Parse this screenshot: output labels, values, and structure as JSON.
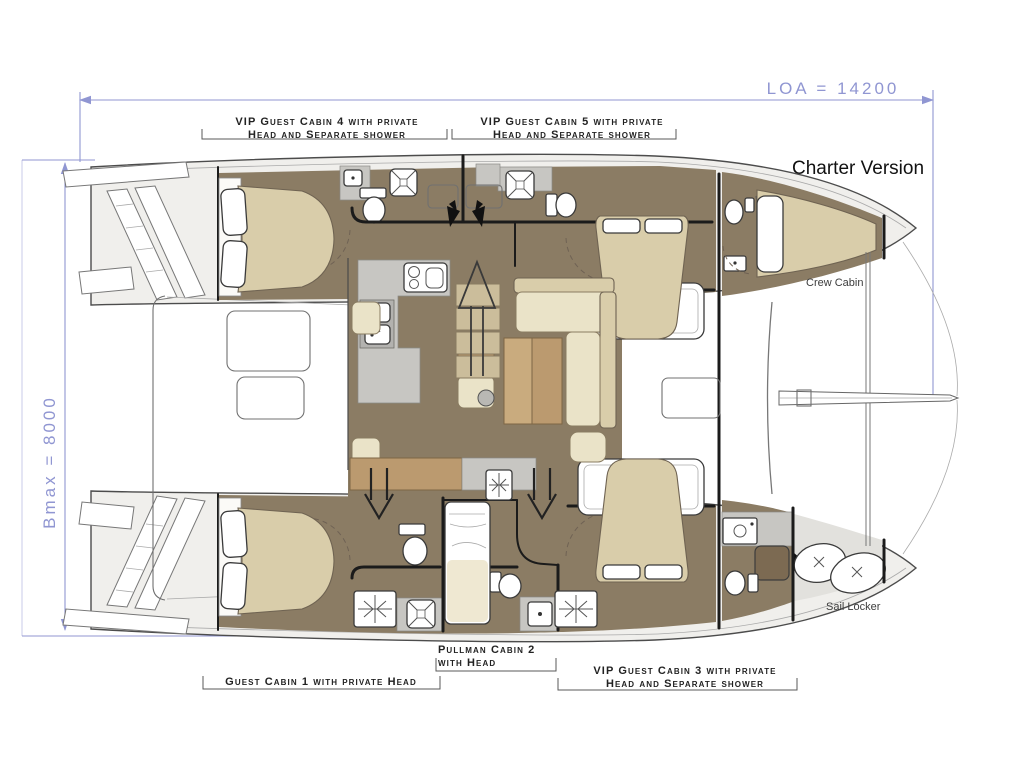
{
  "title": {
    "charter_version": "Charter Version"
  },
  "dimensions": {
    "loa_label": "LOA = 14200",
    "bmax_label": "Bmax = 8000"
  },
  "cabin_labels": {
    "vip4": {
      "line1": "VIP Guest Cabin 4 with private",
      "line2": "Head and Separate shower"
    },
    "vip5": {
      "line1": "VIP Guest Cabin 5 with private",
      "line2": "Head and Separate shower"
    },
    "pullman2": {
      "line1": "Pullman Cabin 2",
      "line2": "with Head"
    },
    "guest1": {
      "line1": "Guest Cabin 1 with private Head"
    },
    "vip3": {
      "line1": "VIP Guest Cabin 3 with private",
      "line2": "Head and Separate shower"
    },
    "crew": {
      "line1": "Crew Cabin"
    },
    "sail_locker": {
      "line1": "Sail Locker"
    }
  },
  "colors": {
    "dimension_blue": "#9096d2",
    "outline_black": "#1b1b1b",
    "deck_gray": "#f0efec",
    "floor_taupe": "#8b7c64",
    "wet_area_gray": "#c7c6c2",
    "mattress_tan": "#d9cdaa",
    "cushion_cream": "#eae3c8",
    "furniture_brown": "#bb9a6f",
    "label_black": "#222222"
  }
}
